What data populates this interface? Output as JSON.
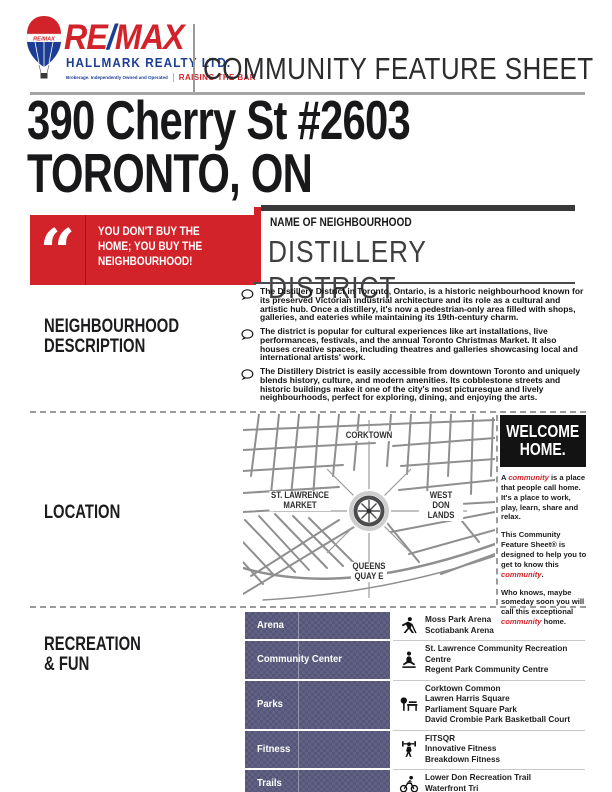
{
  "header": {
    "title": "COMMUNITY FEATURE SHEET",
    "registered": "®",
    "brand": {
      "wordmark_re": "RE",
      "wordmark_slash": "/",
      "wordmark_max": "MAX",
      "company": "HALLMARK REALTY LTD.",
      "fineprint": "Brokerage. Independently Owned and Operated",
      "tagline": "RAISING THE BAR",
      "balloon_label": "RE/MAX"
    }
  },
  "address": {
    "line1": "390 Cherry St #2603",
    "line2": "TORONTO, ON"
  },
  "quote": {
    "mark": "“",
    "text": "YOU DON'T BUY THE\nHOME; YOU BUY THE\nNEIGHBOURHOOD!"
  },
  "neighbourhood": {
    "label": "NAME OF NEIGHBOURHOOD",
    "name": "DISTILLERY DISTRICT"
  },
  "description": {
    "label": "NEIGHBOURHOOD\nDESCRIPTION",
    "paragraphs": [
      "The Distillery District in Toronto, Ontario, is a historic neighbourhood known for its preserved Victorian industrial architecture and its role as a cultural and artistic hub. Once a distillery, it's now a pedestrian-only area filled with shops, galleries, and eateries while maintaining its 19th-century charm.",
      "The district is popular for cultural experiences like art installations, live performances, festivals, and the annual Toronto Christmas Market. It also houses creative spaces, including theatres and galleries showcasing local and international artists' work.",
      "The Distillery District is easily accessible from downtown Toronto and uniquely blends history, culture, and modern amenities. Its cobblestone streets and historic buildings make it one of the city's most picturesque and lively neighbourhoods, perfect for exploring, dining, and enjoying the arts."
    ]
  },
  "location": {
    "label": "LOCATION",
    "map": {
      "top_label": "CORKTOWN",
      "left_label": "ST. LAWRENCE\nMARKET",
      "right_label": "WEST DON\nLANDS",
      "bottom_label": "QUEENS\nQUAY E"
    }
  },
  "welcome": {
    "title": "WELCOME\nHOME.",
    "paragraphs": [
      [
        {
          "text": "A "
        },
        {
          "text": "community",
          "accent": true
        },
        {
          "text": " is a place that people call home. It's a place to work, play, learn, share and relax."
        }
      ],
      [
        {
          "text": "This Community Feature Sheet® is designed to help you to get to know this "
        },
        {
          "text": "community",
          "accent": true
        },
        {
          "text": "."
        }
      ],
      [
        {
          "text": "Who knows, maybe someday soon you will call this exceptional "
        },
        {
          "text": "community",
          "accent": true
        },
        {
          "text": " home."
        }
      ]
    ]
  },
  "recreation": {
    "label": "RECREATION\n& FUN",
    "rows": [
      {
        "category": "Arena",
        "icon": "hockey-player-icon",
        "venues": [
          "Moss Park Arena",
          "Scotiabank Arena"
        ]
      },
      {
        "category": "Community Center",
        "icon": "meditation-icon",
        "venues": [
          "St. Lawrence Community Recreation Centre",
          "Regent Park Community Centre"
        ]
      },
      {
        "category": "Parks",
        "icon": "park-bench-icon",
        "venues": [
          "Corktown Common",
          "Lawren Harris Square",
          "Parliament Square Park",
          "David Crombie Park Basketball Court"
        ]
      },
      {
        "category": "Fitness",
        "icon": "weightlifter-icon",
        "venues": [
          "FITSQR",
          "Innovative Fitness",
          "Breakdown Fitness"
        ]
      },
      {
        "category": "Trails",
        "icon": "cyclist-icon",
        "venues": [
          "Lower Don Recreation Trail",
          "Waterfront Tri"
        ]
      }
    ]
  },
  "colors": {
    "remax_red": "#d2232a",
    "remax_blue": "#1b3e94",
    "table_purple": "#55567a",
    "ink": "#1d1d1f"
  }
}
